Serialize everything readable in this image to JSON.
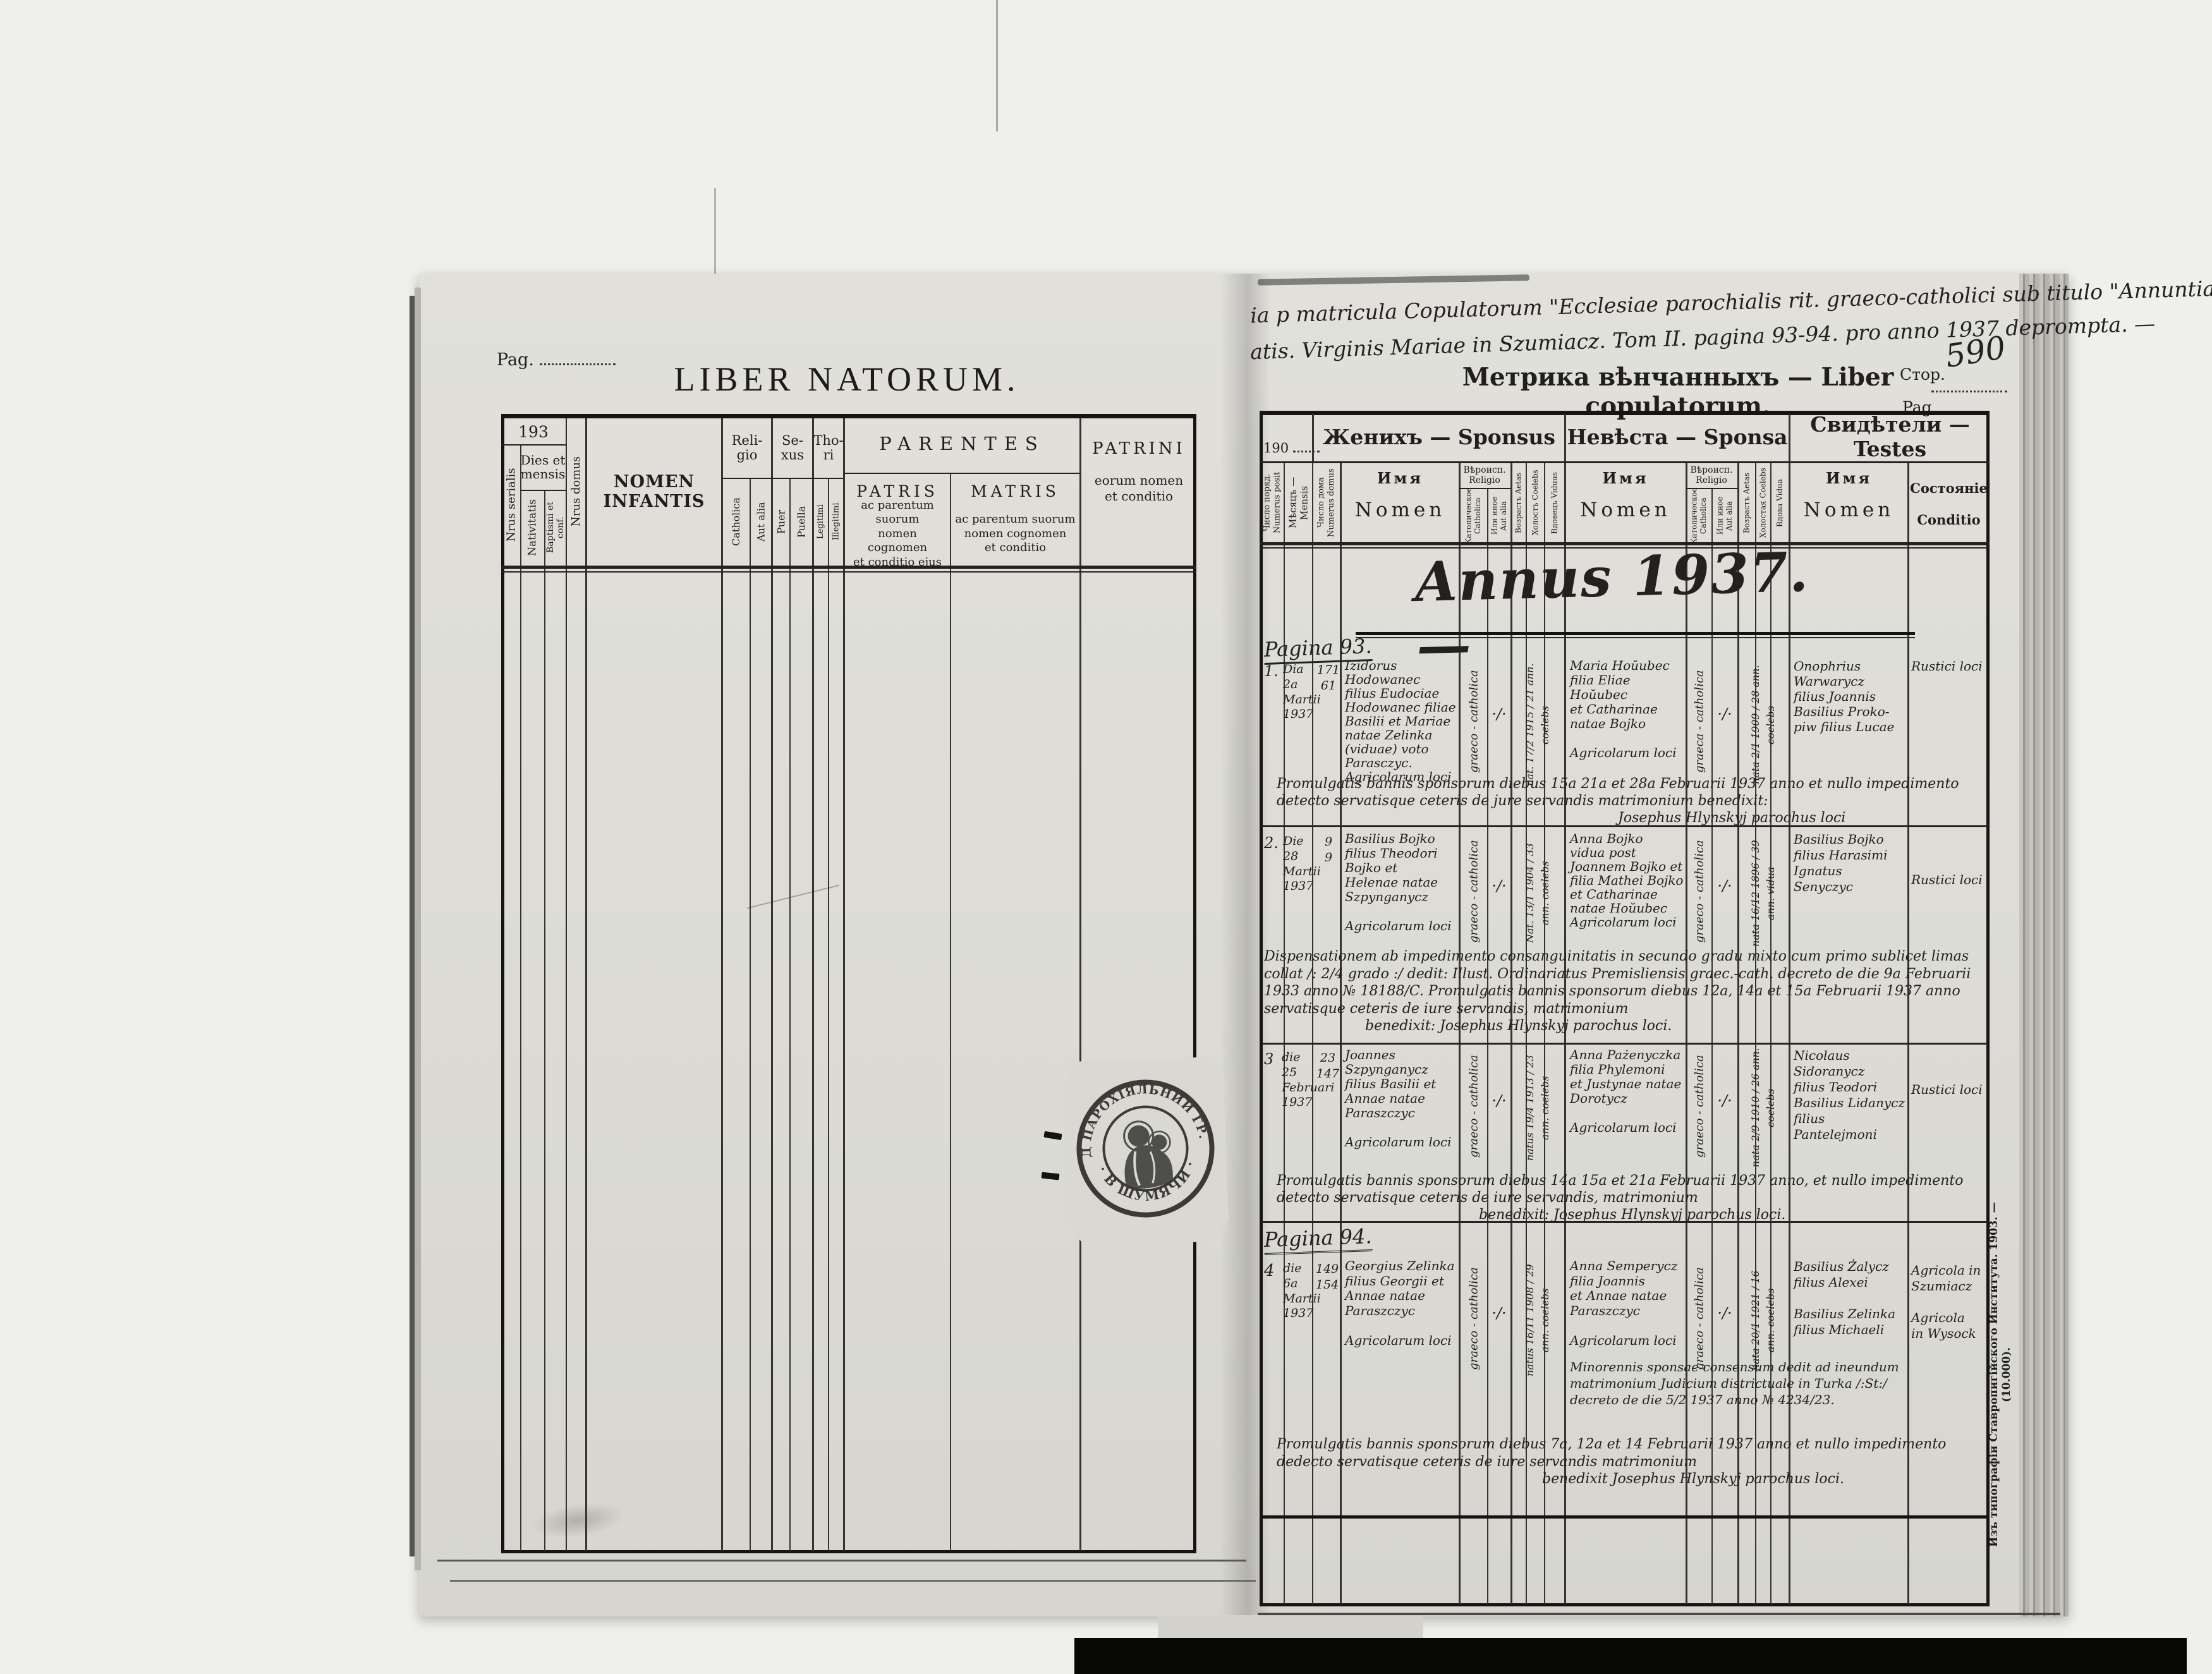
{
  "colors": {
    "paper": "#dddcd6",
    "ink": "#1c1b19",
    "stamp_ink": "#2a2927"
  },
  "left_page": {
    "pag_label": "Pag.",
    "title": "LIBER NATORUM.",
    "table": {
      "year_prefix": "193",
      "dies_et_mensis": "Dies et\nmensis",
      "nrus_serialis": "Nrus serialis",
      "nativitatis": "Nativitatis",
      "baptismi": "Baptismi et conf.",
      "nrus_domus": "Nrus domus",
      "nomen_infantis": "NOMEN INFANTIS",
      "religio": "Reli-\ngio",
      "catholica": "Catholica",
      "aut_alia": "Aut alia",
      "sexus": "Se-\nxus",
      "puer": "Puer",
      "puella": "Puella",
      "thori": "Tho-\nri",
      "legitimi": "Legitimi",
      "illegitimi": "Illegitimi",
      "parentes": "PARENTES",
      "patris": "PATRIS",
      "patris_desc": "ac parentum suorum\nnomen cognomen\net conditio ejus",
      "matris": "MATRIS",
      "matris_desc": "ac parentum suorum\nnomen cognomen\net conditio",
      "patrini": "PATRINI",
      "patrini_desc": "eorum nomen\net conditio"
    },
    "stamp": {
      "arc_top": "УРЯД ПАРОХІЯЛЬНИЙ ГР. КАТ.",
      "arc_bottom": "· В ШУМЯЧИ ·"
    }
  },
  "right_page": {
    "header_note_line1": "ia p matricula Copulatorum \"Ecclesiae parochialis rit. graeco-catholici sub titulo \"Annuntiationis",
    "header_note_line2": "atis. Virginis Mariae in Szumiacz. Tom II. pagina 93-94. pro anno 1937 deprompta. —",
    "title": "Метрика вѣнчанныхъ — Liber copulatorum.",
    "stor_label": "Стор.",
    "pag_label": "Pag.",
    "page_number_handwritten": "590",
    "table": {
      "year_prefix": "190",
      "sponsus": "Женихъ — Sponsus",
      "sponsa": "Невѣста — Sponsa",
      "testes": "Свидѣтели — Testes",
      "numerus_posit": "Число поряд.\nNumerus posit",
      "mensis": "Мѣсяцъ — Mensis",
      "numerus_domus": "Число дома\nNumerus domus",
      "nomen_cyr": "Имя",
      "nomen_lat": "Nomen",
      "religio": "Вѣроисп.\nReligio",
      "catholica": "Католическое\nCatholica",
      "aut_alia": "Или иное\nAut alia",
      "aetas_m": "Возрастъ Aetas",
      "coelebs_m": "Холостъ Coelebs",
      "viduus": "Вдовецъ Viduus",
      "aetas_f": "Возрастъ Aetas",
      "coelebs_f": "Холостая Coelebs",
      "vidua": "Вдова Vidua",
      "conditio": "Состояніе\nConditio"
    },
    "body": {
      "annus_title": "Annus 1937. —",
      "pagina_93": "Pagina 93.",
      "pagina_94": "Pagina 94.",
      "imprint": "Изъ типографіи Ставропигійского Института. 1903. — (10.000).",
      "entries": [
        {
          "num": "1.",
          "date": "Dia\n2a\nMartii\n1937",
          "house": "171\n61",
          "groom": "Izidorus\nHodowanec\nfilius Eudociae\nHodowanec filiae\nBasilii et Mariae\nnatae Zelinka\n(viduae) voto\nParasczyc.\nAgricolarum loci",
          "groom_religio": "graeco - catholica",
          "groom_tick": "·/·",
          "groom_status": "nat. 17/2 1915 / 21 ann.  coelebs",
          "bride": "Maria Hoŭubec\nfilia Eliae Hoŭubec\net Catharinae\nnatae Bojko\n\nAgricolarum loci",
          "bride_religio": "graeca - catholica",
          "bride_tick": "·/·",
          "bride_status": "nata 2/1 1909 / 28 ann.  coelebs",
          "witnesses": "Onophrius\nWarwarycz\nfilius Joannis\nBasilius Proko-\npiw filius Lucae",
          "condition": "Rustici loci",
          "note": "Promulgatis bannis sponsorum diebus 15a 21a et 28a Februarii 1937 anno et nullo impedimento detecto servatisque ceteris de jure servandis matrimonium benedixit:",
          "note_sign": "Josephus Hlynskyj parochus loci"
        },
        {
          "num": "2.",
          "date": "Die\n28\nMartii\n1937",
          "house": "9\n9",
          "groom": "Basilius Bojko\nfilius Theodori\nBojko et\nHelenae natae\nSzpynganycz\n\nAgricolarum loci",
          "groom_religio": "graeco - catholica",
          "groom_tick": "·/·",
          "groom_status": "Nat. 13/1 1904 / 33 ann.  coelebs",
          "bride": "Anna Bojko\nvidua post\nJoannem Bojko et\nfilia Mathei Bojko\net Catharinae\nnatae Hoŭubec\nAgricolarum loci",
          "bride_religio": "graeco - catholica",
          "bride_tick": "·/·",
          "bride_status": "nata 16/12 1896 / 39 ann.  vidua",
          "witnesses": "Basilius Bojko\nfilius Harasimi\nIgnatus\nSenyczyc",
          "condition": "Rustici loci",
          "note": "Dispensationem ab impedimento consanguinitatis in secundo gradu mixto cum primo sublicet limas collat /: 2/4 grado :/ dedit: Illust. Ordinariatus Premisliensis graec.-cath. decreto de die 9a Februarii 1933 anno № 18188/C. Promulgatis bannis sponsorum diebus 12a, 14a et 15a Februarii 1937 anno servatisque ceteris de iure servandis, matrimonium",
          "note_sign": "benedixit: Josephus Hlynskyj parochus loci."
        },
        {
          "num": "3",
          "date": "die\n25\nFebruari\n1937",
          "house": "23\n147",
          "groom": "Joannes\nSzpynganycz\nfilius Basilii et\nAnnae natae\nParaszczyc\n\nAgricolarum loci",
          "groom_religio": "graeco - catholica",
          "groom_tick": "·/·",
          "groom_status": "natus 19/4 1913 / 23 ann.  coelebs",
          "bride": "Anna Pażenyczka\nfilia Phylemoni\net Justynae natae\nDorotycz\n\nAgricolarum loci",
          "bride_religio": "graeco - catholica",
          "bride_tick": "·/·",
          "bride_status": "nata 2/9 1910 / 26 ann.  coelebs",
          "witnesses": "Nicolaus\nSidoranycz\nfilius Teodori\nBasilius Lidanycz\nfilius Pantelejmoni",
          "condition": "Rustici loci",
          "note": "Promulgatis bannis sponsorum diebus 14a 15a et 21a Februarii 1937 anno, et nullo impedimento detecto servatisque ceteris de iure servandis, matrimonium",
          "note_sign": "benedixit: Josephus Hlynskyj parochus loci."
        },
        {
          "num": "4",
          "date": "die\n6a\nMartii\n1937",
          "house": "149\n154",
          "groom": "Georgius Zelinka\nfilius Georgii et\nAnnae natae\nParaszczyc\n\nAgricolarum loci",
          "groom_religio": "graeco - catholica",
          "groom_tick": "·/·",
          "groom_status": "natus 16/11 1908 / 29 ann.  coelebs",
          "bride": "Anna Semperycz\nfilia Joannis\net Annae natae\nParaszczyc\n\nAgricolarum loci",
          "bride_note": "Minorennis sponsae consensum dedit ad ineundum matrimonium Judicium districtuale in Turka /:St:/ decreto de die 5/2 1937 anno № 4234/23.",
          "bride_religio": "graeco - catholica",
          "bride_tick": "·/·",
          "bride_status": "nata 20/1 1921 / 16 ann.  coelebs",
          "witnesses": "Basilius Żalycz\nfilius Alexei\n\nBasilius Zelinka\nfilius Michaeli",
          "condition": "Agricola in\nSzumiacz\n\nAgricola\nin Wysock",
          "note": "Promulgatis bannis sponsorum diebus 7a, 12a et 14 Februarii 1937 anno et nullo impedimento dedecto servatisque ceteris de iure servandis matrimonium",
          "note_sign": "benedixit Josephus Hlynskyj parochus loci."
        }
      ]
    }
  }
}
